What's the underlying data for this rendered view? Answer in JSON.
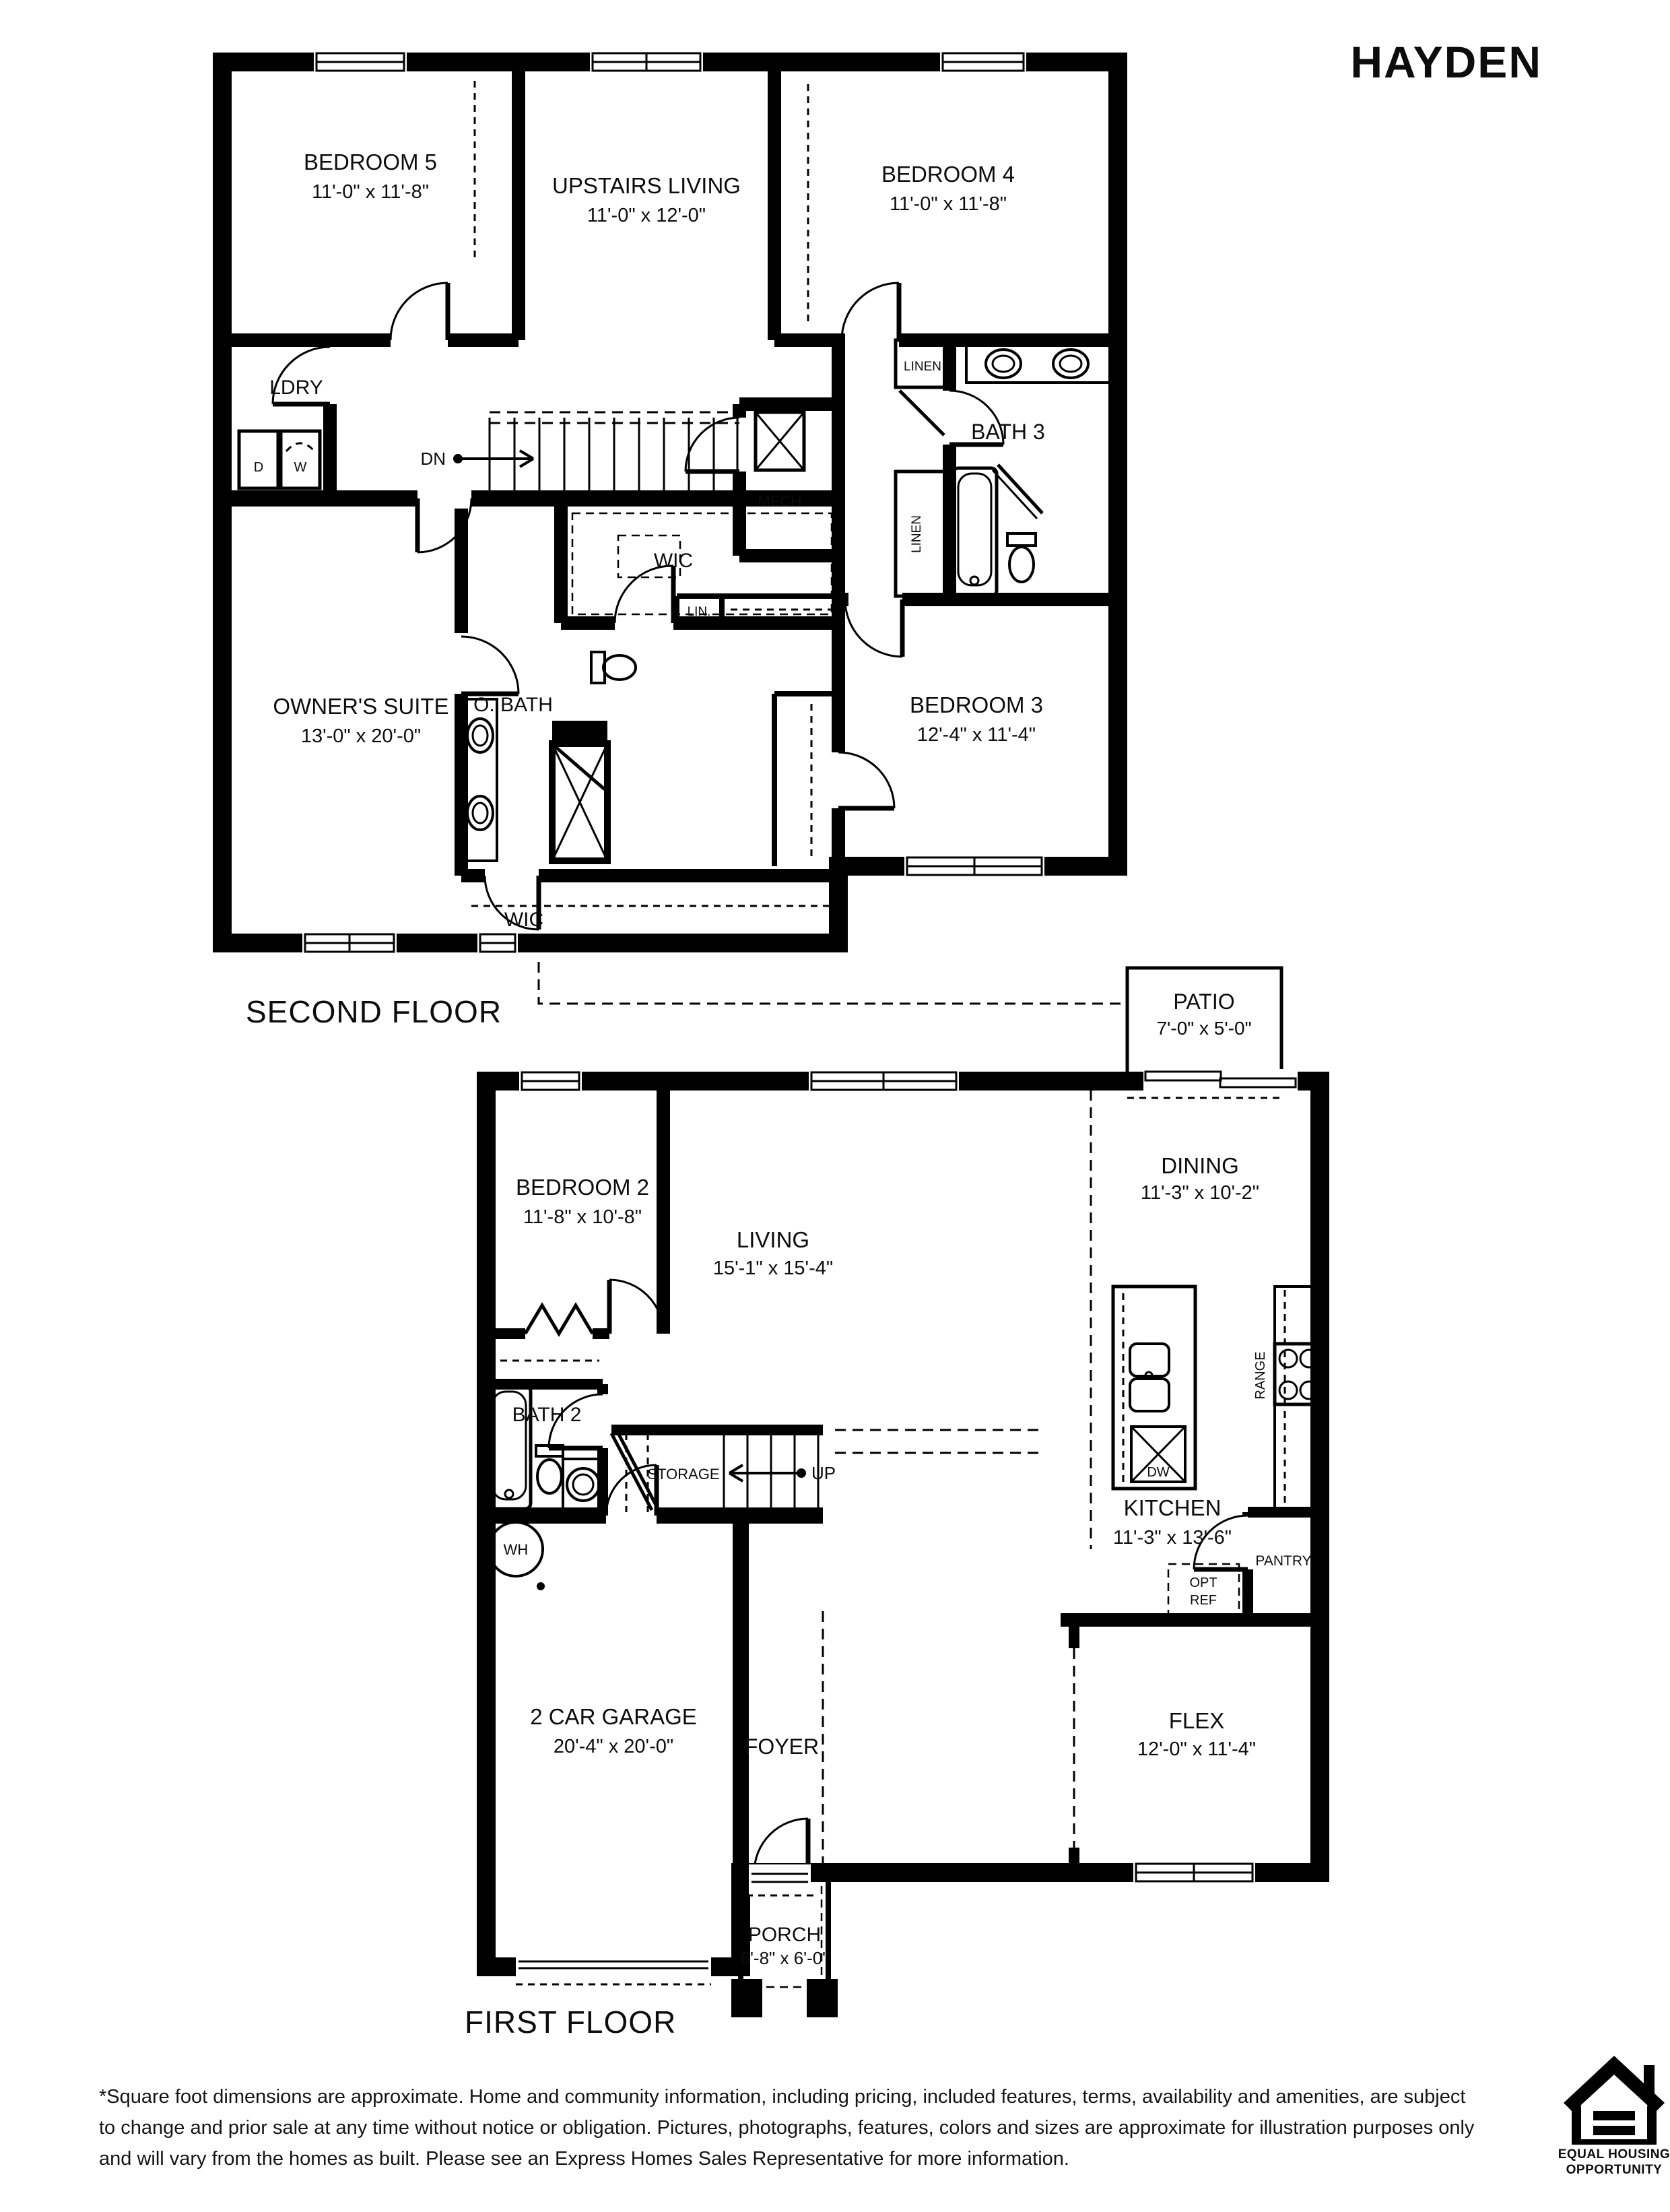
{
  "title": "HAYDEN",
  "second_floor": {
    "title": "SECOND FLOOR",
    "bedroom5": {
      "name": "BEDROOM 5",
      "dims": "11'-0\" x 11'-8\""
    },
    "upstairs_living": {
      "name": "UPSTAIRS LIVING",
      "dims": "11'-0\" x 12'-0\""
    },
    "bedroom4": {
      "name": "BEDROOM 4",
      "dims": "11'-0\" x 11'-8\""
    },
    "ldry": "LDRY",
    "dryer": "D",
    "washer": "W",
    "dn": "DN",
    "mech": "MECH",
    "wic_hall": "WIC",
    "lin": "LIN.",
    "linen_top": "LINEN",
    "linen_side": "LINEN",
    "bath3": "BATH 3",
    "owners_suite": {
      "name": "OWNER'S SUITE",
      "dims": "13'-0\" x 20'-0\""
    },
    "obath": "O. BATH",
    "bedroom3": {
      "name": "BEDROOM 3",
      "dims": "12'-4\" x 11'-4\""
    },
    "wic_owner": "WIC"
  },
  "first_floor": {
    "title": "FIRST FLOOR",
    "patio": {
      "name": "PATIO",
      "dims": "7'-0\" x 5'-0\""
    },
    "bedroom2": {
      "name": "BEDROOM 2",
      "dims": "11'-8\" x 10'-8\""
    },
    "living": {
      "name": "LIVING",
      "dims": "15'-1\" x 15'-4\""
    },
    "dining": {
      "name": "DINING",
      "dims": "11'-3\" x 10'-2\""
    },
    "kitchen": {
      "name": "KITCHEN",
      "dims": "11'-3\" x 13'-6\""
    },
    "bath2": "BATH 2",
    "storage": "STORAGE",
    "up": "UP",
    "wh": "WH",
    "range": "RANGE",
    "dw": "DW",
    "opt_ref_line1": "OPT",
    "opt_ref_line2": "REF",
    "pantry": "PANTRY",
    "garage": {
      "name": "2 CAR GARAGE",
      "dims": "20'-4\" x 20'-0\""
    },
    "foyer": "FOYER",
    "flex": {
      "name": "FLEX",
      "dims": "12'-0\" x 11'-4\""
    },
    "porch": {
      "name": "PORCH",
      "dims": "6'-8\" x 6'-0\""
    }
  },
  "disclaimer": {
    "line1": "*Square foot dimensions are approximate. Home and community information, including pricing, included features, terms, availability and amenities, are subject",
    "line2": "to change and prior sale at any time without notice or obligation. Pictures, photographs, features, colors and sizes are approximate for illustration purposes only",
    "line3": "and will vary from the homes as built. Please see an Express Homes Sales Representative for more information."
  },
  "equal_housing": {
    "line1": "EQUAL HOUSING",
    "line2": "OPPORTUNITY"
  }
}
